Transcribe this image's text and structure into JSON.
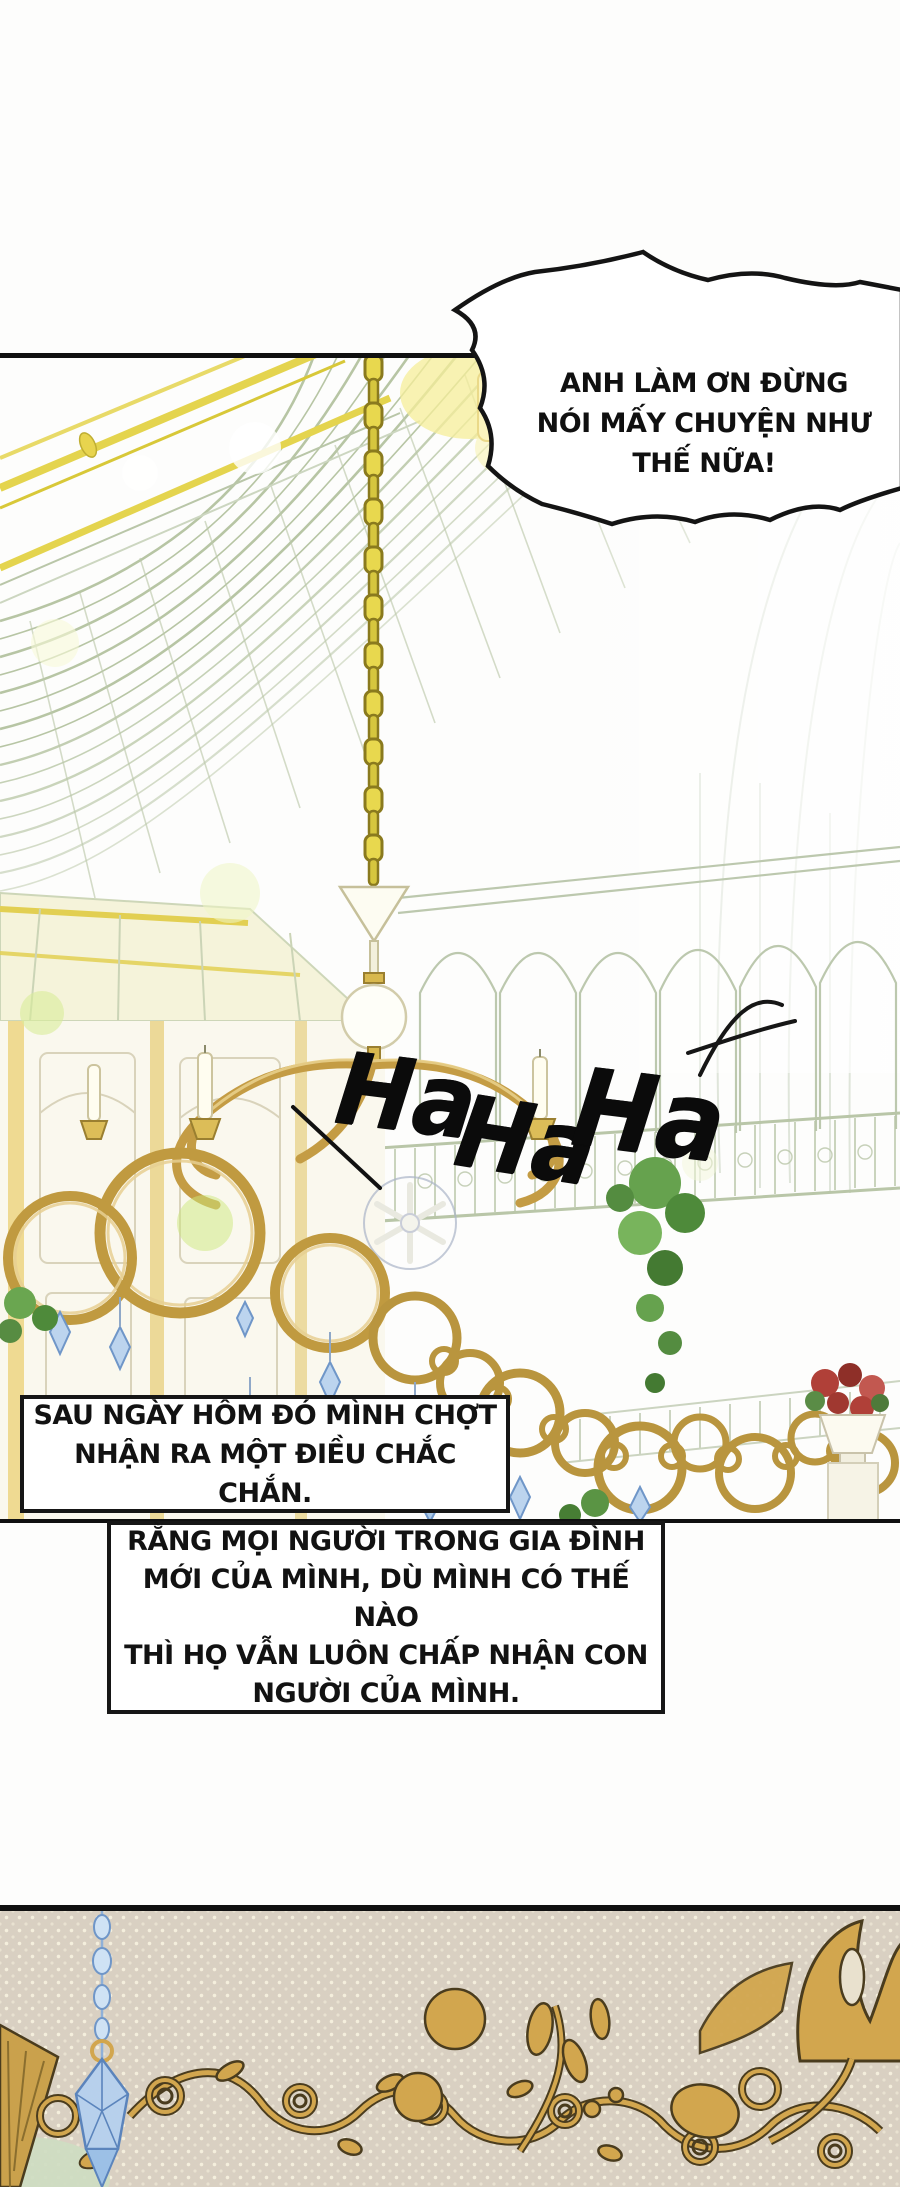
{
  "speech_bubble": {
    "lines": [
      "ANH LÀM ƠN ĐỪNG",
      "NÓI MẤY CHUYỆN NHƯ",
      "THẾ NỮA!"
    ]
  },
  "laugh_sfx": {
    "combined": "Ha HaHa",
    "parts": [
      "Ha",
      "Ha",
      "Ha"
    ]
  },
  "caption_box_1": {
    "lines": [
      "SAU NGÀY HÔM ĐÓ MÌNH CHỢT",
      "NHẬN RA MỘT ĐIỀU CHẮC CHẮN."
    ]
  },
  "caption_box_2": {
    "lines": [
      "RẰNG MỌI NGƯỜI TRONG GIA ĐÌNH",
      "MỚI CỦA MÌNH, DÙ MÌNH CÓ THẾ NÀO",
      "THÌ HỌ VẪN LUÔN CHẤP NHẬN CON",
      "NGƯỜI CỦA MÌNH."
    ]
  },
  "colors": {
    "panel_border_black": "#101010",
    "structure_line_green": "#b7c5a4",
    "roof_gold": "#e4d44e",
    "chain_yellow": "#e0d04a",
    "chandelier_gold": "#c09a40",
    "crystal_blue": "#b7d0ec",
    "plant_green": "#66a24e",
    "flower_red": "#b04038",
    "ornament_gold": "#d2a64e",
    "bottom_panel_beige": "#d9d0c2",
    "caption_bg_white": "#ffffff"
  },
  "icons": {
    "sfx-stroke-mark": "hand-drawn flourish stroke",
    "speed-line": "diagonal motion stroke"
  }
}
